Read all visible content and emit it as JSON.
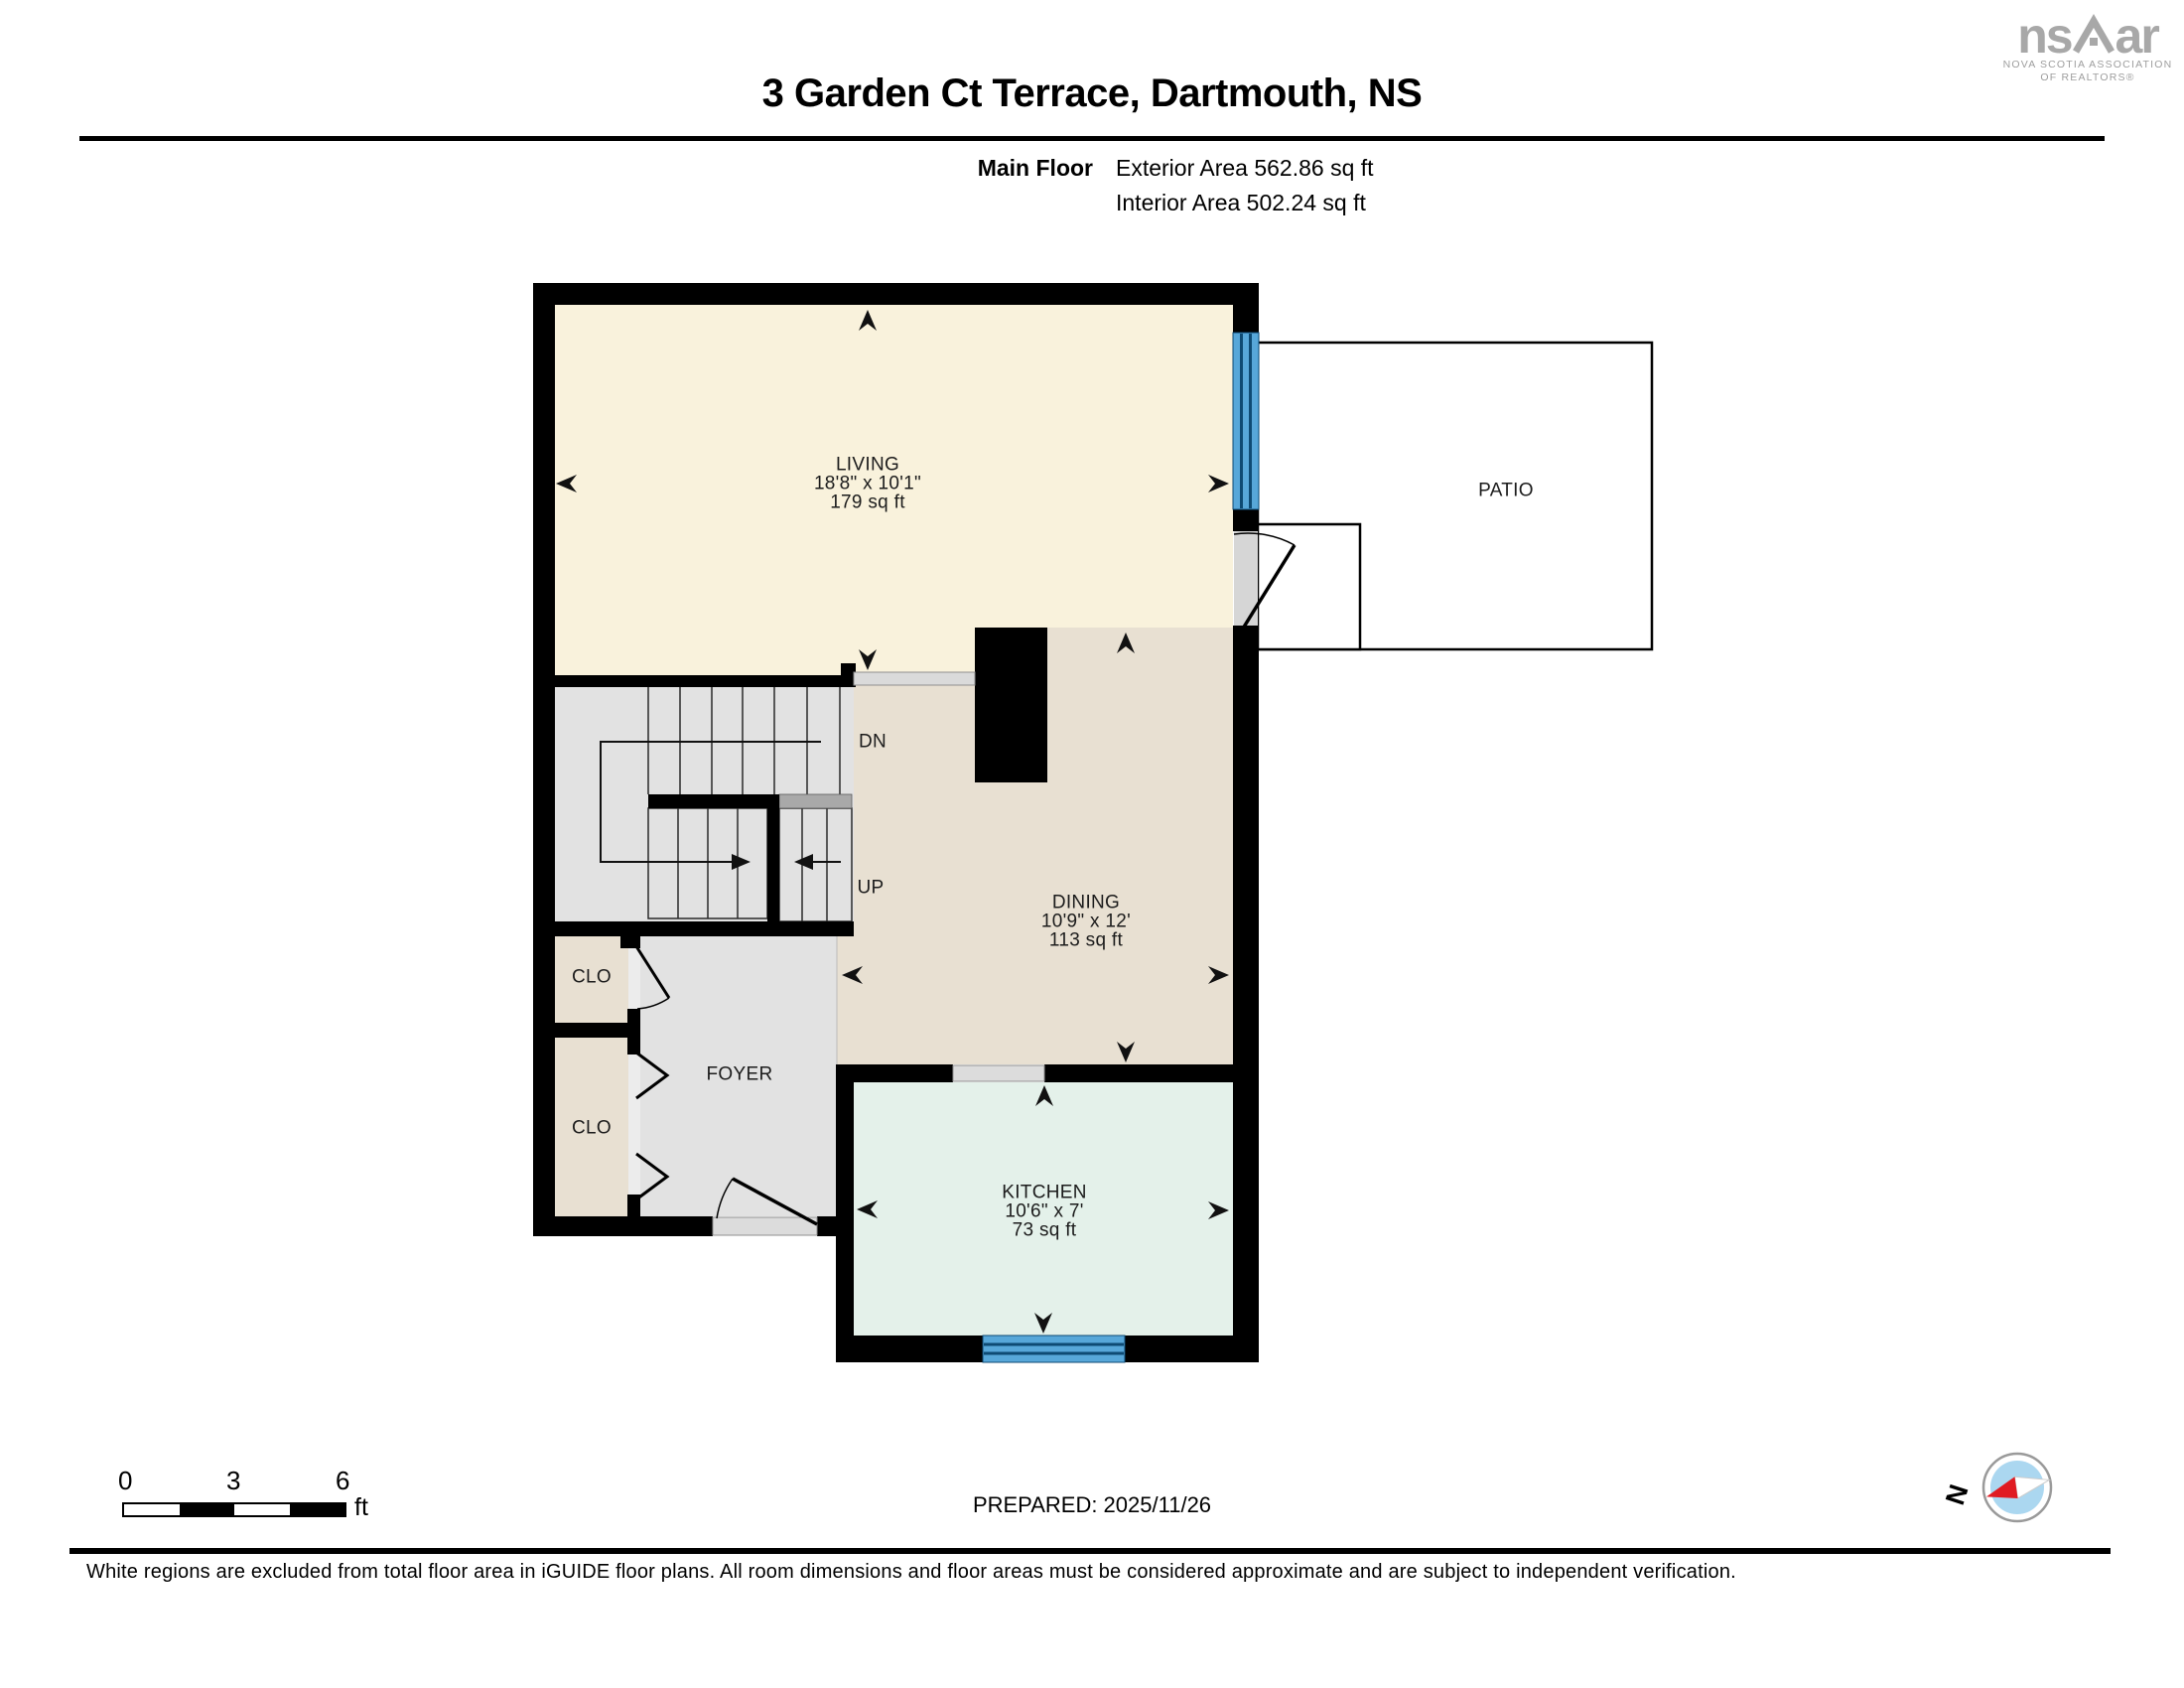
{
  "header": {
    "title": "3 Garden Ct Terrace, Dartmouth, NS",
    "floor_label": "Main Floor",
    "exterior_area": "Exterior Area 562.86 sq ft",
    "interior_area": "Interior Area 502.24 sq ft"
  },
  "logo": {
    "mark_left": "ns",
    "mark_right": "ar",
    "subtitle_line1": "NOVA SCOTIA ASSOCIATION",
    "subtitle_line2": "OF REALTORS®"
  },
  "rooms": {
    "living": {
      "name": "LIVING",
      "dimensions": "18'8\" x 10'1\"",
      "area": "179 sq ft"
    },
    "dining": {
      "name": "DINING",
      "dimensions": "10'9\" x 12'",
      "area": "113 sq ft"
    },
    "kitchen": {
      "name": "KITCHEN",
      "dimensions": "10'6\" x 7'",
      "area": "73 sq ft"
    },
    "foyer": {
      "name": "FOYER"
    },
    "patio": {
      "name": "PATIO"
    },
    "closet_upper": {
      "name": "CLO"
    },
    "closet_lower": {
      "name": "CLO"
    },
    "stairs": {
      "down": "DN",
      "up": "UP"
    }
  },
  "scale_bar": {
    "ticks": [
      "0",
      "3",
      "6"
    ],
    "unit": "ft"
  },
  "compass": {
    "north": "N"
  },
  "prepared": {
    "label": "PREPARED: 2025/11/26"
  },
  "disclaimer": "White regions are excluded from total floor area in iGUIDE floor plans. All room dimensions and floor areas must be considered approximate and are subject to independent verification.",
  "colors": {
    "wall": "#000000",
    "living_floor": "#F9F2DC",
    "dining_floor": "#E8E0D2",
    "kitchen_floor": "#E4F1EA",
    "hall_floor": "#E2E2E2",
    "window_blue": "#57A7D9",
    "window_line": "#0E4A73",
    "logo_gray": "#A8A8A8",
    "compass_red": "#E01B22",
    "compass_blue": "#ABD7F0"
  }
}
